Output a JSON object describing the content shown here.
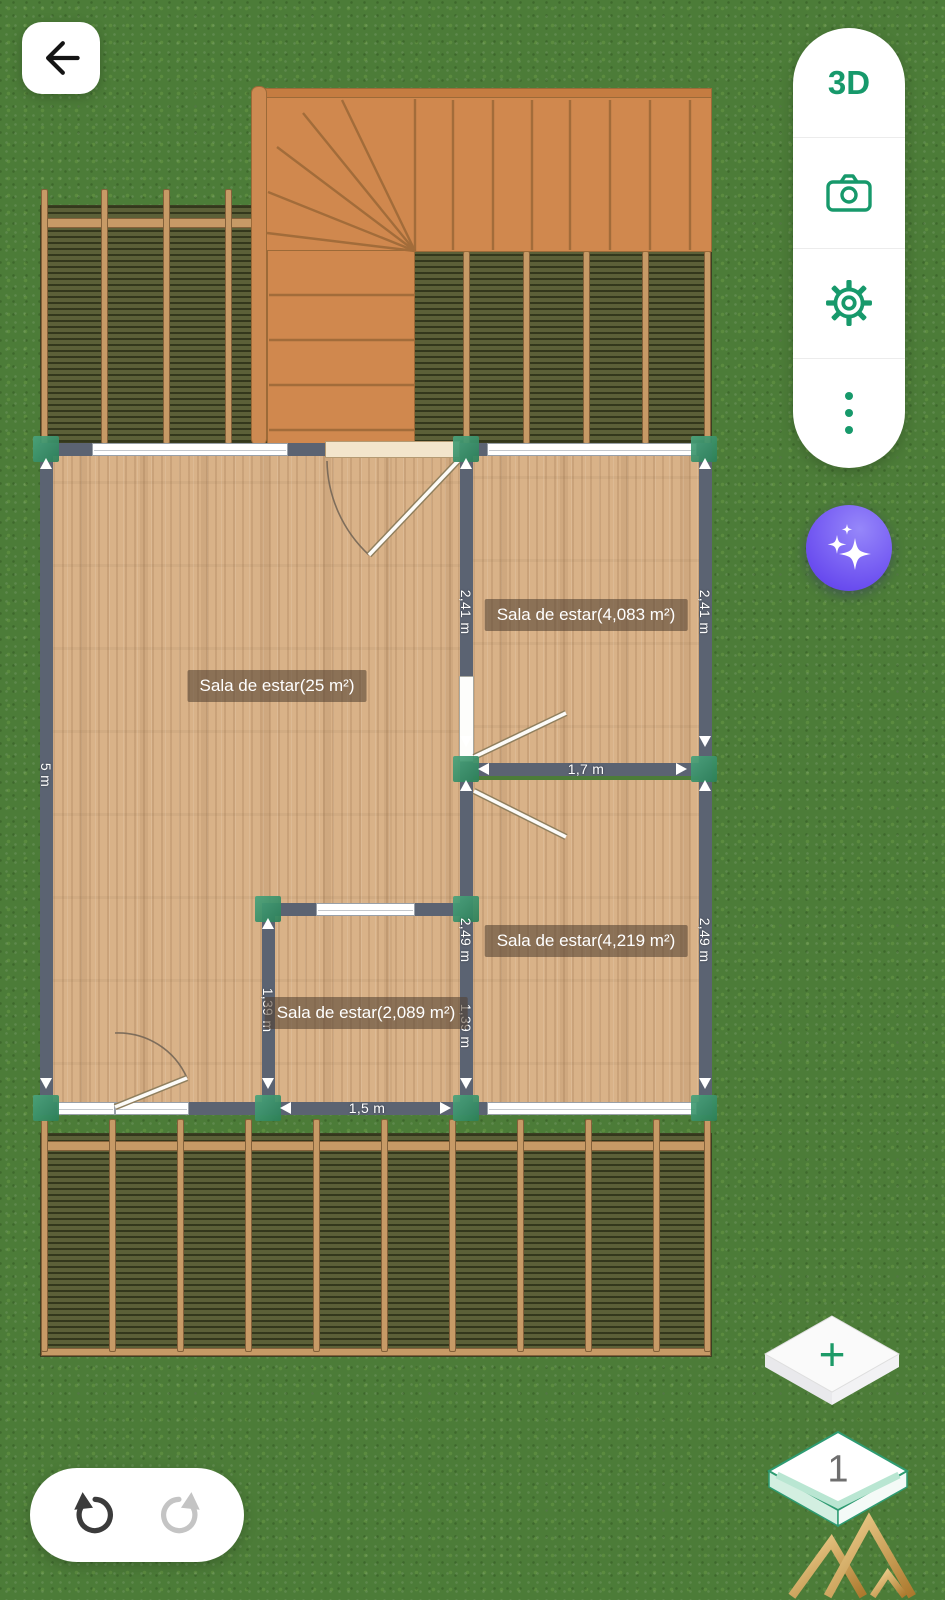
{
  "nav": {
    "back_icon": "arrow-left-icon"
  },
  "toolbar": {
    "view_3d_label": "3D",
    "camera_icon": "camera-icon",
    "settings_icon": "gear-icon",
    "more_icon": "kebab-menu-icon"
  },
  "ai_button": {
    "icon": "ai-sparkles-icon"
  },
  "floor_plan": {
    "rooms": [
      {
        "label": "Sala de estar(25 m²)"
      },
      {
        "label": "Sala de estar(4,083 m²)"
      },
      {
        "label": "Sala de estar(4,219 m²)"
      },
      {
        "label": "Sala de estar(2,089 m²)"
      }
    ],
    "dimensions": {
      "outer_left": "5 m",
      "room2_left": "2,41 m",
      "room2_right": "2,41 m",
      "room3_left": "2,49 m",
      "room3_right": "2,49 m",
      "room4_left": "1,39 m",
      "room4_right": "1,39 m",
      "divider_wall": "1,7 m",
      "room4_bottom": "1,5 m"
    }
  },
  "history": {
    "undo_icon": "undo-icon",
    "redo_icon": "redo-icon"
  },
  "floors": {
    "add_label": "+",
    "current": "1"
  },
  "colors": {
    "accent_green": "#17996b",
    "wall": "#5b6372",
    "grass": "#4c7c38",
    "wood_floor": "#d9b288",
    "stair_wood": "#d0884e",
    "ai_purple": "#6c4ef0",
    "node_green": "#2f8f6a"
  }
}
